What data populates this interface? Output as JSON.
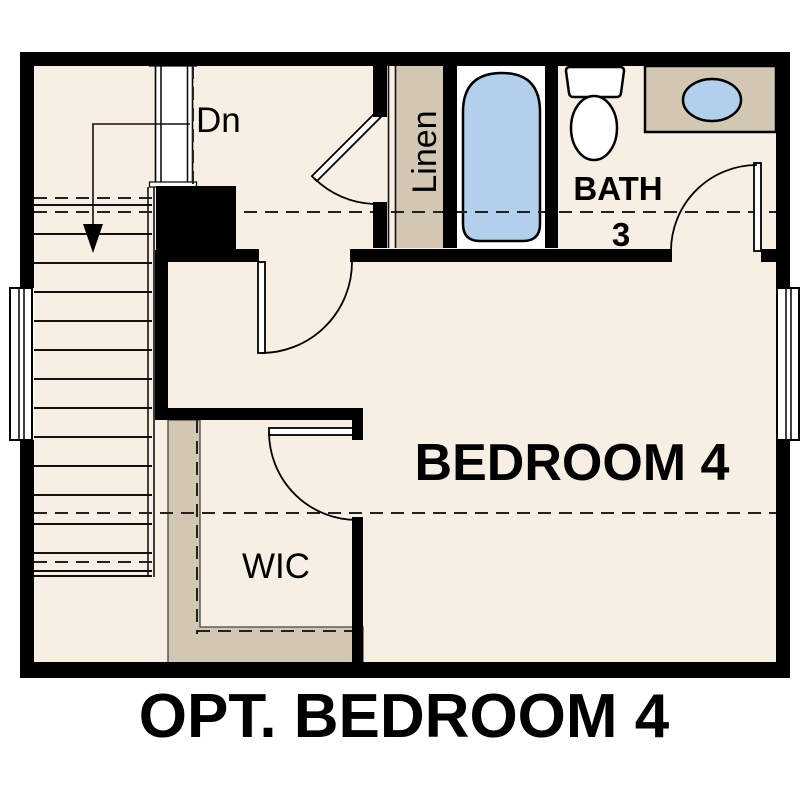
{
  "page_title": "OPT. BEDROOM 4",
  "plan": {
    "labels": {
      "stairs_direction": "Dn",
      "linen": "Linen",
      "bath_name": "BATH",
      "bath_number": "3",
      "bedroom": "BEDROOM 4",
      "closet": "WIC"
    },
    "fixtures": [
      "staircase-down",
      "bathtub",
      "toilet",
      "sink-basin",
      "linen-closet",
      "walk-in-closet",
      "window-left",
      "window-right"
    ]
  },
  "colors": {
    "floor": "#f7efe3",
    "tan": "#d2c7b2",
    "fixture-blue": "#b2d0ec",
    "wall": "#000000",
    "line": "#111111",
    "dash": "#222222",
    "page-bg": "#ffffff"
  }
}
